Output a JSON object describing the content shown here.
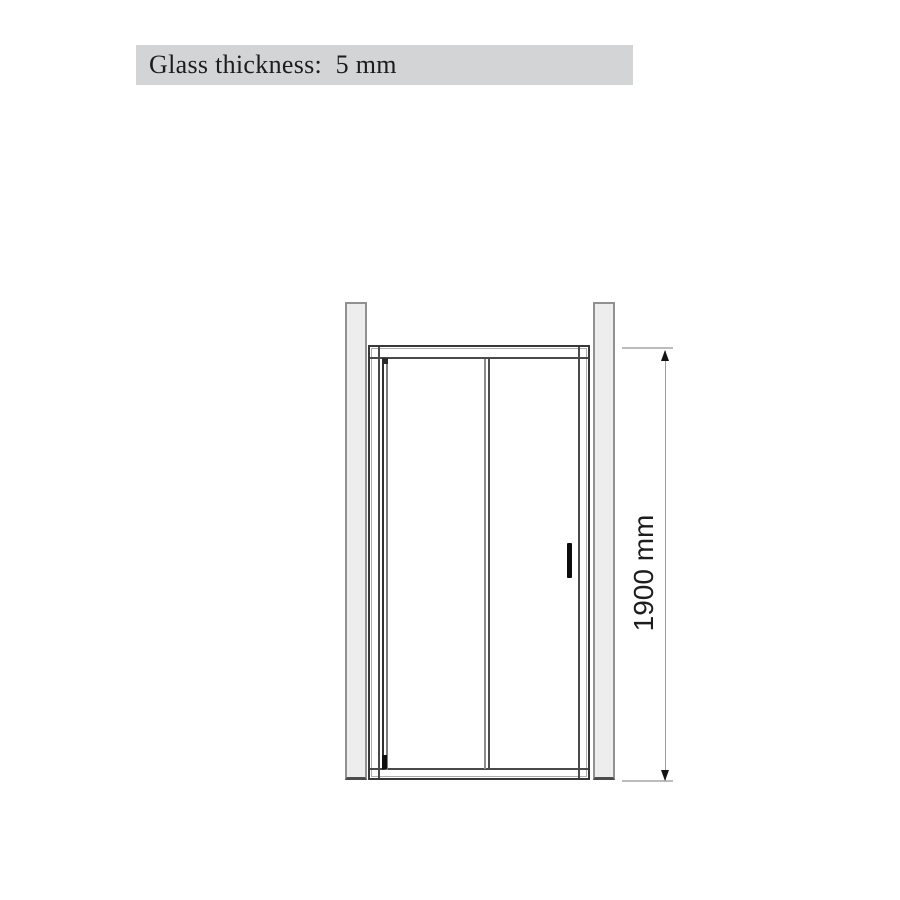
{
  "banner": {
    "label": "Glass thickness:  5 mm",
    "bg_color": "#d2d4d6",
    "text_color": "#1c1c1c"
  },
  "diagram": {
    "height_dimension": {
      "label": "1900 mm",
      "value_mm": 1900
    },
    "colors": {
      "wall_profile_fill": "#ededed",
      "wall_profile_border": "#909090",
      "frame_line_dark": "#383838",
      "frame_line_light": "#aeaeae",
      "handle": "#0c0c0c",
      "dimension_line": "#9e9e9e",
      "extension_line": "#bcbcbc",
      "arrow": "#141414"
    }
  }
}
